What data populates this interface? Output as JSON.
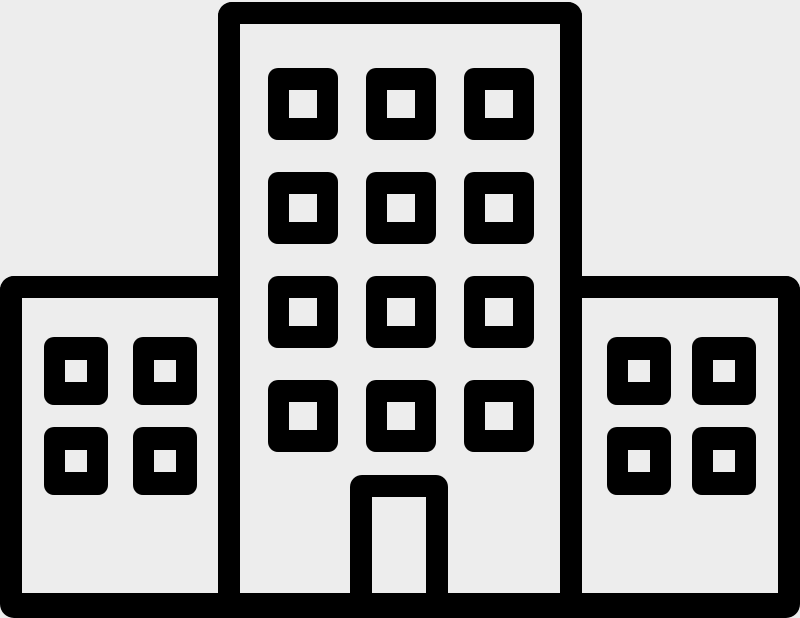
{
  "background_color": "#ededed",
  "icon": {
    "name": "building-icon",
    "color": "#000000",
    "parts": {
      "central_tower": {
        "name": "central-tower",
        "window_rows": 4,
        "window_cols": 3,
        "window_count": 12,
        "has_door": true
      },
      "left_wing": {
        "name": "left-wing",
        "window_rows": 2,
        "window_cols": 2,
        "window_count": 4
      },
      "right_wing": {
        "name": "right-wing",
        "window_rows": 2,
        "window_cols": 2,
        "window_count": 4
      },
      "ground_line": {
        "name": "ground-line"
      },
      "door": {
        "name": "door"
      }
    }
  }
}
